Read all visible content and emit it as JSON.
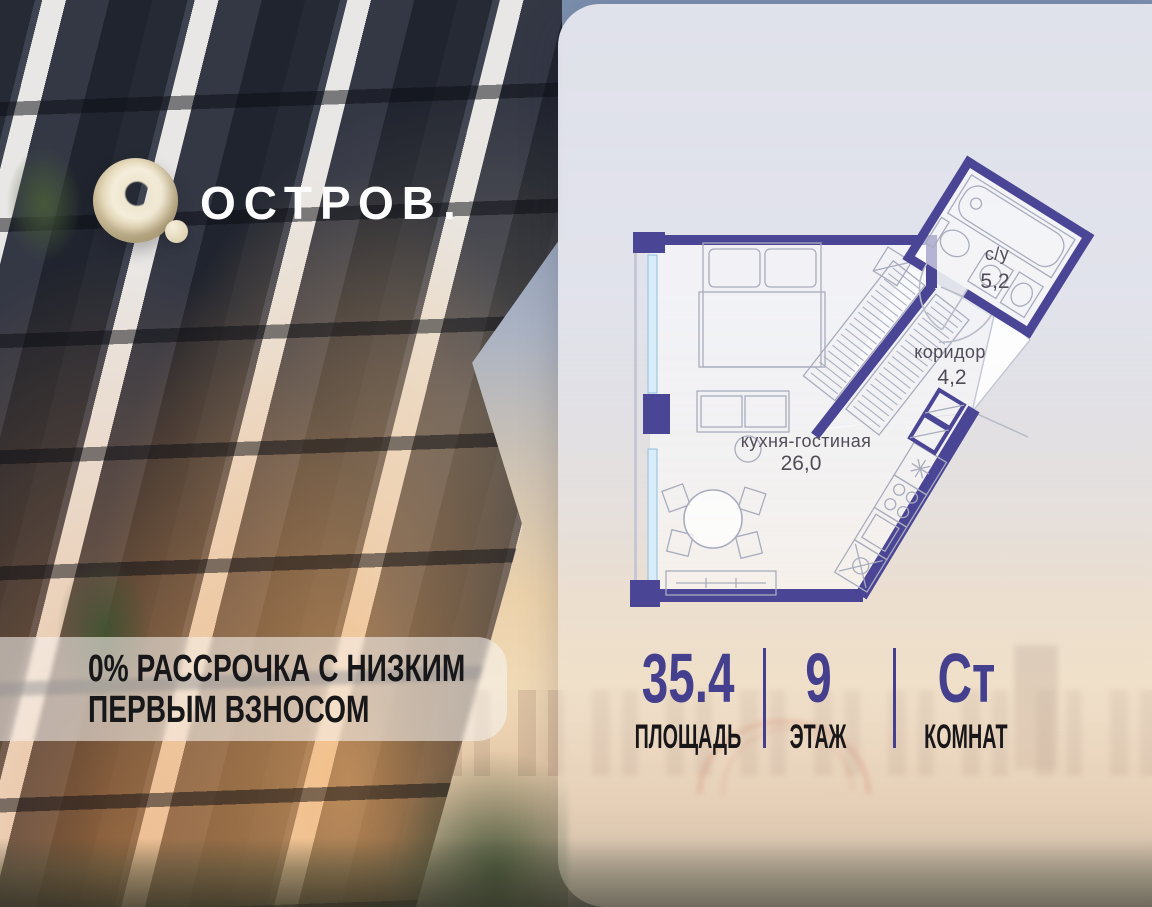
{
  "brand": {
    "logo_text": "ОСТРОВ."
  },
  "promo": {
    "line1": "0% РАССРОЧКА С НИЗКИМ",
    "line2": "ПЕРВЫМ ВЗНОСОМ"
  },
  "plan": {
    "rooms": [
      {
        "name": "с/у",
        "area": "5,2"
      },
      {
        "name": "коридор",
        "area": "4,2"
      },
      {
        "name": "кухня-гостиная",
        "area": "26,0"
      }
    ]
  },
  "stats": [
    {
      "value": "35.4",
      "label": "ПЛОЩАДЬ"
    },
    {
      "value": "9",
      "label": "ЭТАЖ"
    },
    {
      "value": "Ст",
      "label": "КОМНАТ"
    }
  ],
  "colors": {
    "wall": "#4a4594",
    "accent": "#45408d",
    "logo_cream": "#efe6cf"
  }
}
